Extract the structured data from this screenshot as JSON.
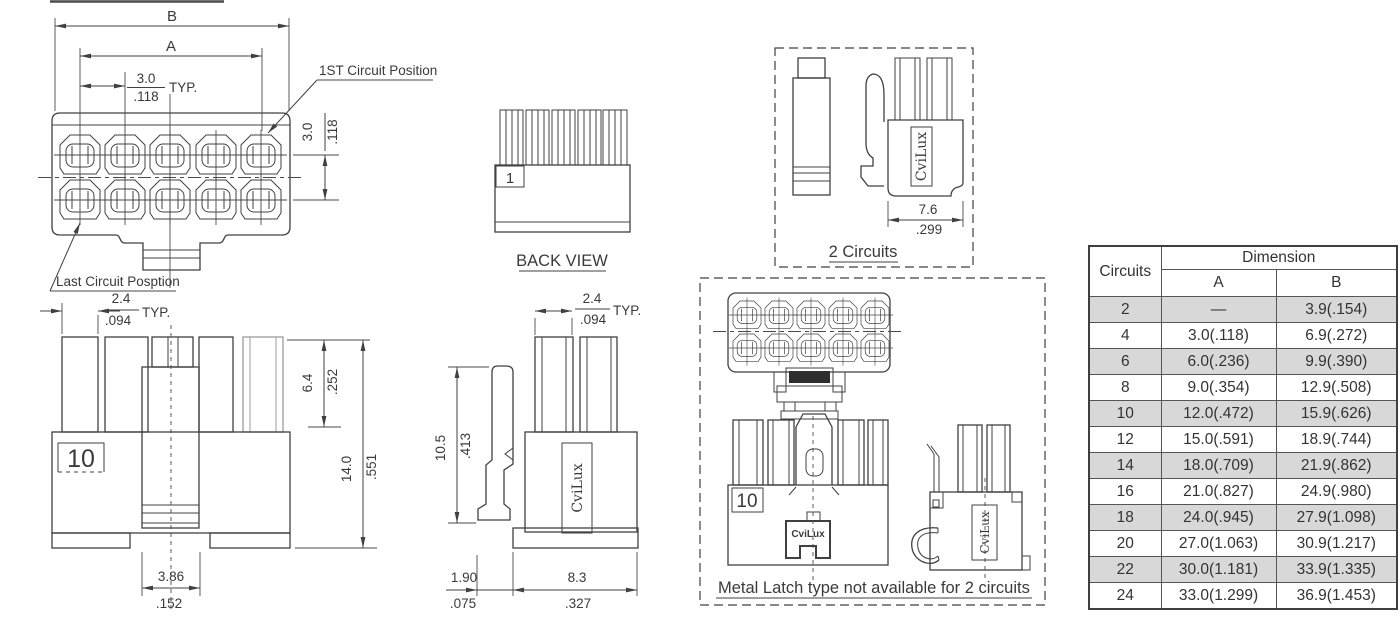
{
  "drawing": {
    "front_view": {
      "dim_b": "B",
      "dim_a": "A",
      "pitch_mm": "3.0",
      "pitch_in": ".118",
      "pitch_typ": "TYP.",
      "row_pitch_mm": "3.0",
      "row_pitch_in": ".118",
      "callout_first": "1ST Circuit Position",
      "callout_last": "Last Circuit Posption"
    },
    "back_view": {
      "position_label": "1",
      "caption": "BACK VIEW"
    },
    "two_circuits_view": {
      "logo": "CviLux",
      "width_mm": "7.6",
      "width_in": ".299",
      "caption": "2 Circuits"
    },
    "side_view_left": {
      "position_label": "10",
      "pitch_mm": "2.4",
      "pitch_in": ".094",
      "pitch_typ": "TYP.",
      "pin_height_mm": "6.4",
      "pin_height_in": ".252",
      "total_height_mm": "14.0",
      "total_height_in": ".551",
      "latch_width_mm": "3.86",
      "latch_width_in": ".152"
    },
    "side_view_center": {
      "logo": "CviLux",
      "pitch_mm": "2.4",
      "pitch_in": ".094",
      "pitch_typ": "TYP.",
      "latch_height_mm": "10.5",
      "latch_height_in": ".413",
      "offset_mm": "1.90",
      "offset_in": ".075",
      "body_width_mm": "8.3",
      "body_width_in": ".327"
    },
    "metal_latch_view": {
      "position_label": "10",
      "logo_front": "CviLux",
      "logo_side": "CviLux",
      "caption": "Metal Latch type not available for 2 circuits"
    }
  },
  "dimension_table": {
    "header_circuits": "Circuits",
    "header_dimension": "Dimension",
    "header_a": "A",
    "header_b": "B",
    "rows": [
      {
        "circuits": "2",
        "a": "—",
        "b": "3.9(.154)",
        "shaded": true
      },
      {
        "circuits": "4",
        "a": "3.0(.118)",
        "b": "6.9(.272)",
        "shaded": false
      },
      {
        "circuits": "6",
        "a": "6.0(.236)",
        "b": "9.9(.390)",
        "shaded": true
      },
      {
        "circuits": "8",
        "a": "9.0(.354)",
        "b": "12.9(.508)",
        "shaded": false
      },
      {
        "circuits": "10",
        "a": "12.0(.472)",
        "b": "15.9(.626)",
        "shaded": true
      },
      {
        "circuits": "12",
        "a": "15.0(.591)",
        "b": "18.9(.744)",
        "shaded": false
      },
      {
        "circuits": "14",
        "a": "18.0(.709)",
        "b": "21.9(.862)",
        "shaded": true
      },
      {
        "circuits": "16",
        "a": "21.0(.827)",
        "b": "24.9(.980)",
        "shaded": false
      },
      {
        "circuits": "18",
        "a": "24.0(.945)",
        "b": "27.9(1.098)",
        "shaded": true
      },
      {
        "circuits": "20",
        "a": "27.0(1.063)",
        "b": "30.9(1.217)",
        "shaded": false
      },
      {
        "circuits": "22",
        "a": "30.0(1.181)",
        "b": "33.9(1.335)",
        "shaded": true
      },
      {
        "circuits": "24",
        "a": "33.0(1.299)",
        "b": "36.9(1.453)",
        "shaded": false
      }
    ]
  },
  "colors": {
    "line": "#404040",
    "text": "#3a3a3a",
    "shaded_row": "#d8d8d8",
    "phantom_line": "#9c9c9c",
    "background": "#ffffff"
  }
}
